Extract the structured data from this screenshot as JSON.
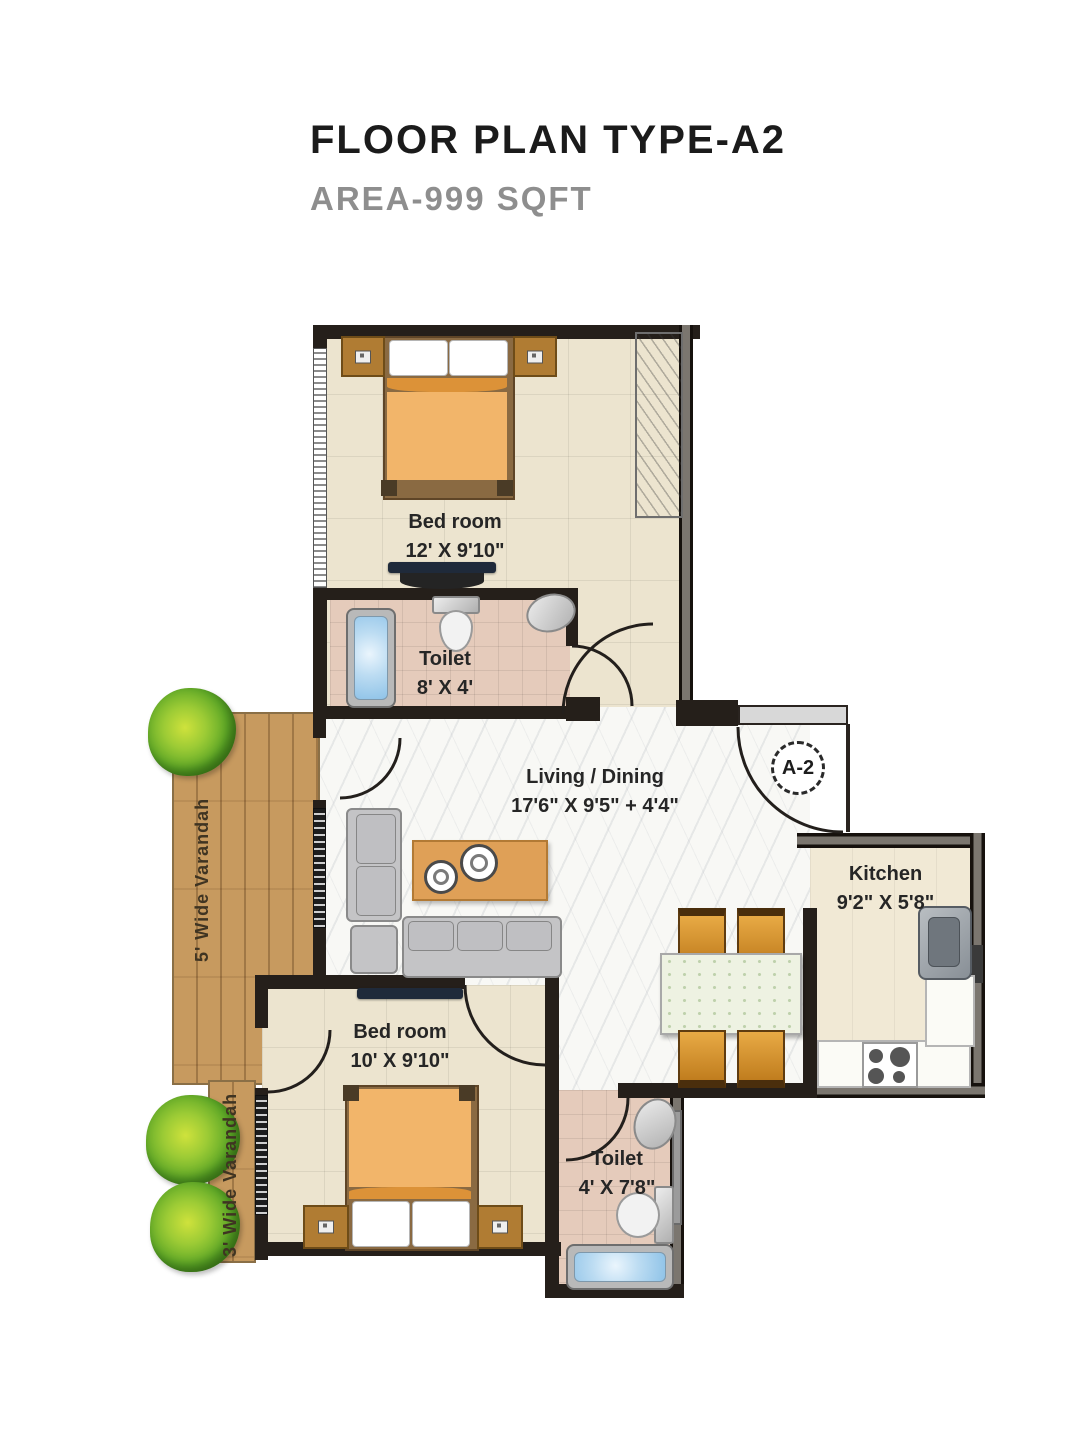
{
  "header": {
    "title": "FLOOR PLAN TYPE-A2",
    "subtitle": "AREA-999 SQFT"
  },
  "unit_badge": {
    "label": "A-2"
  },
  "rooms": {
    "bedroom_top": {
      "name": "Bed room",
      "dims": "12' X 9'10\""
    },
    "toilet_top": {
      "name": "Toilet",
      "dims": "8' X 4'"
    },
    "living_dining": {
      "name": "Living / Dining",
      "dims": "17'6\" X 9'5\" + 4'4\""
    },
    "kitchen": {
      "name": "Kitchen",
      "dims": "9'2\" X 5'8\""
    },
    "bedroom_bottom": {
      "name": "Bed room",
      "dims": "10' X 9'10\""
    },
    "toilet_bottom": {
      "name": "Toilet",
      "dims": "4' X 7'8\""
    },
    "verandah_wide": {
      "name": "5' Wide Varandah"
    },
    "verandah_narrow": {
      "name": "3' Wide Varandah"
    }
  },
  "colors": {
    "wall": "#251f1a",
    "bedroom_floor": "#ece4cf",
    "toilet_floor": "#e5cbbb",
    "living_floor": "#f8f8f5",
    "kitchen_floor": "#f1e9d5",
    "verandah_wood": "#c79a5f",
    "bed_blanket": "#f2b56a",
    "table_wood": "#dfa057",
    "chair": "#d99b3c",
    "tub_blue": "#bcdcf2",
    "tree_green": "#6cb32e",
    "title_text": "#1b1b1b",
    "subtitle_text": "#8e8e8e",
    "label_text": "#262626"
  }
}
